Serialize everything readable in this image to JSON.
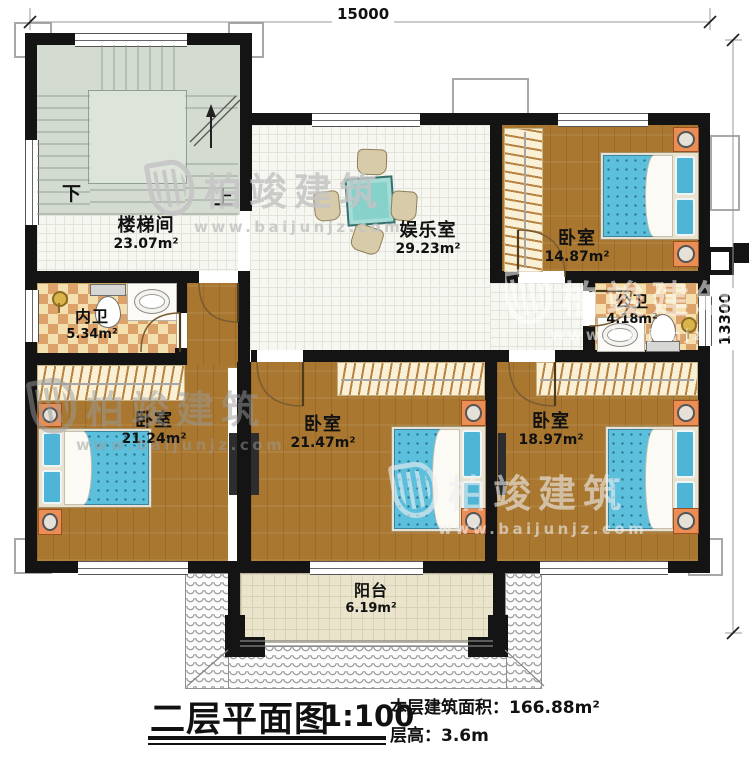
{
  "title_block": {
    "title": "二层平面图",
    "scale": "1:100",
    "area_label": "本层建筑面积：",
    "area_value": "166.88m²",
    "floor_height_label": "层高：",
    "floor_height_value": "3.6m"
  },
  "dimensions": {
    "width": "15000",
    "height": "13300"
  },
  "stairs": {
    "down_label": "下",
    "up_label": "上"
  },
  "watermark": {
    "brand": "柏竣建筑",
    "url": "www.baijunjz.com"
  },
  "rooms": [
    {
      "id": "stairwell",
      "name": "楼梯间",
      "area": "23.07m²"
    },
    {
      "id": "entertainment",
      "name": "娱乐室",
      "area": "29.23m²"
    },
    {
      "id": "bedroom-ne",
      "name": "卧室",
      "area": "14.87m²"
    },
    {
      "id": "bath-inner",
      "name": "内卫",
      "area": "5.34m²"
    },
    {
      "id": "bath-public",
      "name": "公卫",
      "area": "4.18m²"
    },
    {
      "id": "bedroom-sw",
      "name": "卧室",
      "area": "21.24m²"
    },
    {
      "id": "bedroom-s",
      "name": "卧室",
      "area": "21.47m²"
    },
    {
      "id": "bedroom-se",
      "name": "卧室",
      "area": "18.97m²"
    },
    {
      "id": "balcony",
      "name": "阳台",
      "area": "6.19m²"
    }
  ],
  "colors": {
    "wall": "#141414",
    "wood_floor": "#a9772f",
    "tile_floor": "#f7f7f2",
    "bath_checker_a": "#f4dfae",
    "bath_checker_b": "#dca26a",
    "stair_floor": "#d4dcd2",
    "bed_blue": "#5cc0dc",
    "nightstand_orange": "#ea8e55",
    "table_teal": "#87d1cb"
  }
}
